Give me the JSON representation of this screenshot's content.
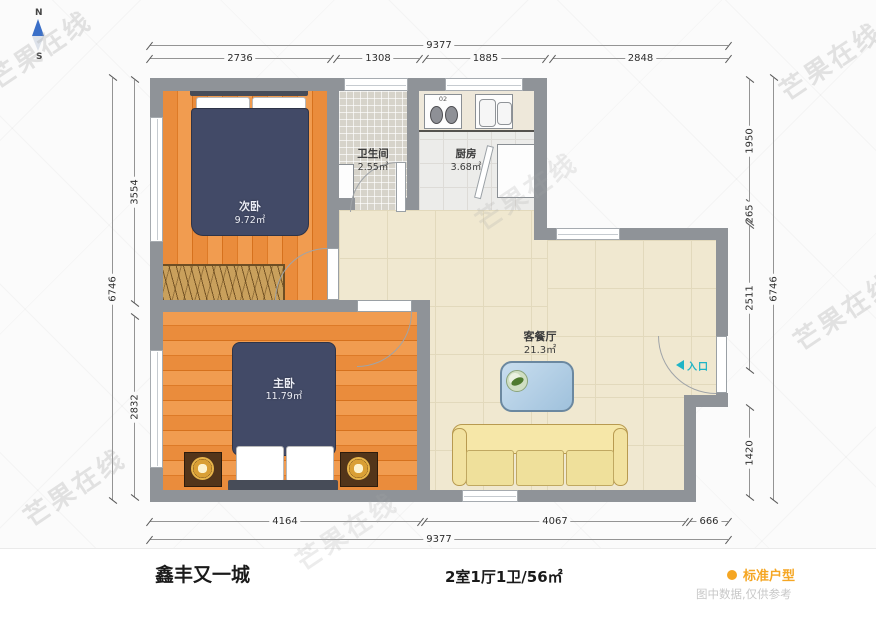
{
  "compass": {
    "north_label": "N",
    "south_label": "S"
  },
  "watermark_text": "芒果在线",
  "rooms": {
    "secondary_bedroom": {
      "name": "次卧",
      "area": "9.72㎡"
    },
    "bathroom": {
      "name": "卫生间",
      "area": "2.55㎡"
    },
    "kitchen": {
      "name": "厨房",
      "area": "3.68㎡"
    },
    "living_dining": {
      "name": "客餐厅",
      "area": "21.3㎡"
    },
    "master_bedroom": {
      "name": "主卧",
      "area": "11.79㎡"
    }
  },
  "entrance": {
    "label": "入口"
  },
  "kitchen_fixtures": {
    "stove_label": "02"
  },
  "dimensions": {
    "top": {
      "total": "9377",
      "segments": [
        "2736",
        "1308",
        "1885",
        "2848"
      ]
    },
    "bottom": {
      "total": "9377",
      "segments": [
        "4164",
        "4067",
        "666"
      ]
    },
    "left": {
      "total": "6746",
      "segments": [
        "3554",
        "2832"
      ]
    },
    "right": {
      "total": "6746",
      "segments": [
        "1950",
        "265",
        "2511",
        "1420"
      ]
    }
  },
  "footer": {
    "community_name": "鑫丰又一城",
    "layout_summary": "2室1厅1卫/56㎡",
    "legend_label": "标准户型",
    "disclaimer": "图中数据,仅供参考"
  },
  "colors": {
    "accent_orange": "#f5a623",
    "entrance_cyan": "#1fb4c6",
    "wall_gray": "#8f9398",
    "wood_orange": "#ea8c3c",
    "duvet_navy": "#424a67",
    "sofa_yellow": "#f6e7a8",
    "table_blue": "#b7d3e8"
  }
}
